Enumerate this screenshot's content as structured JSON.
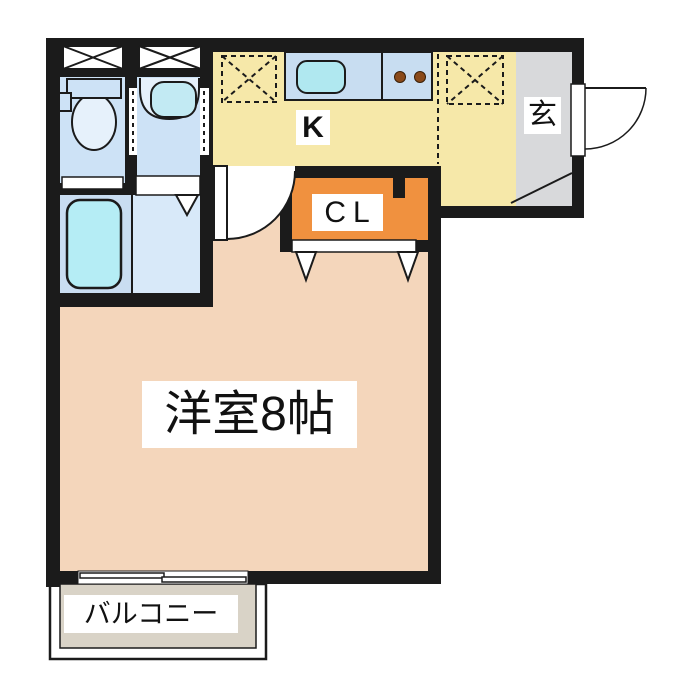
{
  "rooms": {
    "kitchen": {
      "label": "K"
    },
    "entrance_hall": {
      "label": "玄"
    },
    "closet": {
      "label": "CL"
    },
    "western_room": {
      "label": "洋室8帖"
    },
    "balcony": {
      "label": "バルコニー"
    }
  },
  "colors": {
    "background": "#ffffff",
    "wall": "#1b1b1b",
    "kitchen": "#f6e8a9",
    "entrance_yellow": "#f6e8a9",
    "entrance_gray": "#d8d9db",
    "closet": "#f0913f",
    "western_room": "#f4d6bb",
    "balcony": "#d9d3c7",
    "toilet_room": "#cde2f6",
    "washbasin_room": "#cde2f6",
    "bathroom": "#d8e9f9",
    "tub_zone": "#c9ddf1",
    "tub": "#b5edf5",
    "counter": "#c8ddf1",
    "sink": "#b0e8f0",
    "fixture_fill": "#e6f1fb",
    "basin_bowl": "#c2eaf3",
    "burner": "#8a4a1a",
    "label_bg": "#ffffff",
    "text": "#111111"
  }
}
